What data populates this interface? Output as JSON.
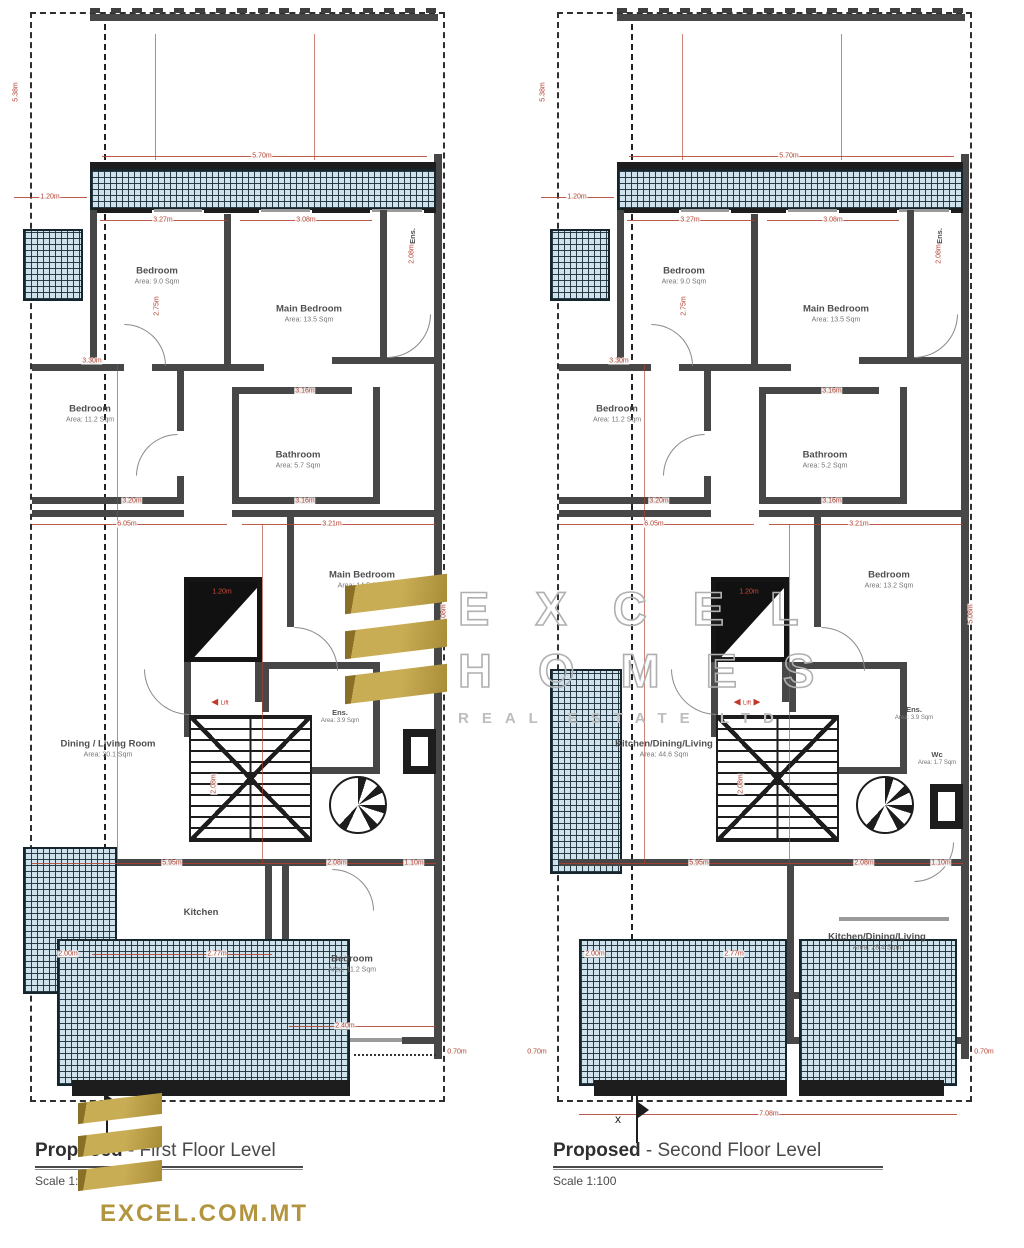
{
  "page": {
    "width": 1024,
    "height": 1248,
    "bg": "#ffffff"
  },
  "colors": {
    "dimension_red": "#b1402f",
    "gold": "#b3953f",
    "hatch_blue": "#cfe2ec",
    "wall_gray": "#474747",
    "ink": "#1d1d1d",
    "label_gray": "#4f4f4f",
    "watermark_gray": "#b0b0b0"
  },
  "watermark": {
    "line1": "EXCEL",
    "line2": "HOMES",
    "line3": "REAL ESTATE LTD"
  },
  "website": "EXCEL.COM.MT",
  "plans": {
    "left": {
      "title_bold": "Proposed",
      "title_rest": " - First Floor Level",
      "scale": "Scale 1:100",
      "marker": "x",
      "lift_label": "Lift",
      "rooms": {
        "bedroom_top": {
          "name": "Bedroom",
          "area": "Area: 9.0 Sqm"
        },
        "main_bedroom_top": {
          "name": "Main Bedroom",
          "area": "Area: 13.5 Sqm"
        },
        "ens_top": {
          "name": "Ens."
        },
        "bedroom_left": {
          "name": "Bedroom",
          "area": "Area: 11.2 Sqm"
        },
        "bathroom": {
          "name": "Bathroom",
          "area": "Area: 5.7 Sqm"
        },
        "main_bedroom_mid": {
          "name": "Main Bedroom",
          "area": "Area: 14.5 Sqm"
        },
        "ens_mid": {
          "name": "Ens.",
          "area": "Area: 3.9 Sqm"
        },
        "dining": {
          "name": "Dining / Living Room",
          "area": "Area: 30.1 Sqm"
        },
        "kitchen": {
          "name": "Kitchen"
        },
        "bedroom_bottom": {
          "name": "Bedroom",
          "area": "Area: 11.2 Sqm"
        }
      },
      "dims": {
        "top": "5.70m",
        "balcony_offset": "1.20m",
        "bed1": "3.27m",
        "main1": "3.08m",
        "bed2_top": "3.30m",
        "bed2_bot": "3.20m",
        "bath_top": "3.16m",
        "bath_bot": "3.16m",
        "span_left": "6.05m",
        "span_right": "3.21m",
        "lift": "1.20m",
        "corridor": "5.95m",
        "lobby": "2.08m",
        "spiral": "1.10m",
        "kitchen_left": "2.00m",
        "kitchen": "2.77m",
        "bed3": "2.40m",
        "out_right": "0.70m",
        "v1": "5.38m",
        "v2": "2.75m",
        "v3": "2.08m",
        "v4": "5.08m",
        "v5": "2.08m"
      }
    },
    "right": {
      "title_bold": "Proposed",
      "title_rest": " - Second Floor Level",
      "scale": "Scale 1:100",
      "marker": "x",
      "lift_label": "Lift",
      "rooms": {
        "bedroom_top": {
          "name": "Bedroom",
          "area": "Area: 9.0 Sqm"
        },
        "main_bedroom_top": {
          "name": "Main Bedroom",
          "area": "Area: 13.5 Sqm"
        },
        "ens_top": {
          "name": "Ens."
        },
        "bedroom_left": {
          "name": "Bedroom",
          "area": "Area: 11.2 Sqm"
        },
        "bathroom": {
          "name": "Bathroom",
          "area": "Area: 5.2 Sqm"
        },
        "bedroom_mid": {
          "name": "Bedroom",
          "area": "Area: 13.2 Sqm"
        },
        "kdl_left": {
          "name": "Kitchen/Dining/Living",
          "area": "Area: 44.6 Sqm"
        },
        "ens_mid": {
          "name": "Ens.",
          "area": "Area: 3.9 Sqm"
        },
        "wc": {
          "name": "Wc",
          "area": "Area: 1.7 Sqm"
        },
        "kdl_bottom": {
          "name": "Kitchen/Dining/Living",
          "area": "Area: 28.4 Sqm"
        }
      },
      "dims": {
        "top": "5.70m",
        "balcony_offset": "1.20m",
        "bed1": "3.27m",
        "main1": "3.08m",
        "bed2_top": "3.30m",
        "bed2_bot": "3.20m",
        "bath_top": "3.16m",
        "bath_bot": "3.16m",
        "span_left": "6.05m",
        "span_right": "3.21m",
        "lift": "1.20m",
        "corridor": "5.95m",
        "lobby": "2.08m",
        "spiral": "1.10m",
        "kitchen_left": "2.00m",
        "kitchen": "2.77m",
        "bed3": "2.40m",
        "out_right": "0.70m",
        "out_left": "0.70m",
        "bottom": "7.08m",
        "v1": "5.38m",
        "v2": "2.75m",
        "v3": "2.08m",
        "v4": "5.08m",
        "v5": "2.08m"
      }
    }
  }
}
